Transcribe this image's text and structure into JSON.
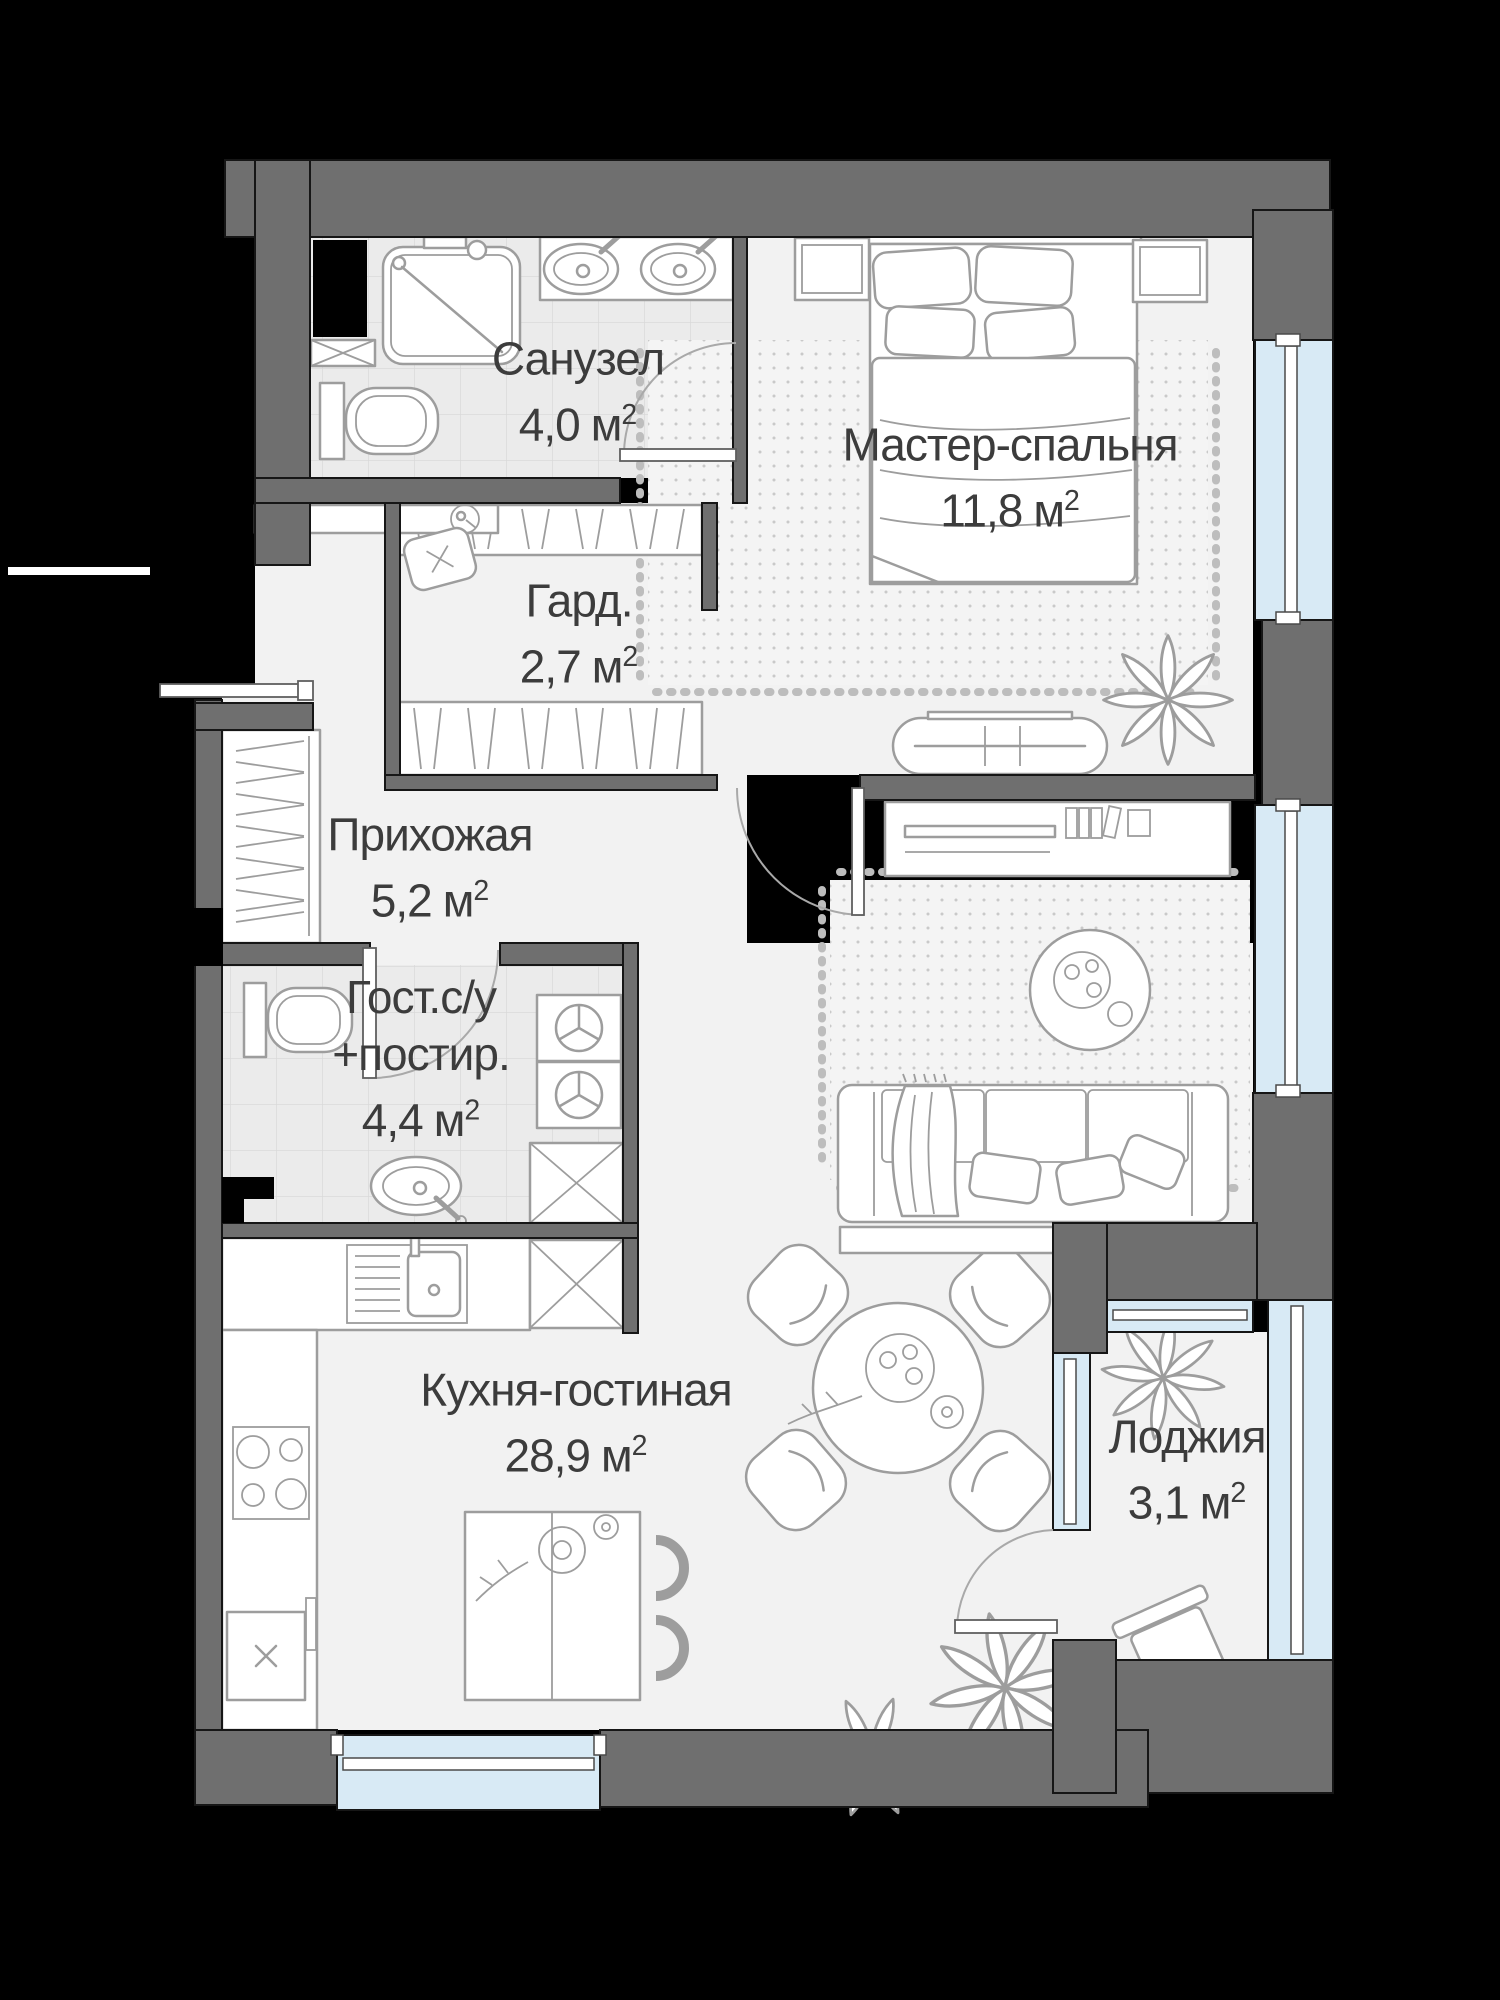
{
  "colors": {
    "background": "#000000",
    "wall": "#6f6f6f",
    "floor": "#f2f2f2",
    "tile": "#ebebeb",
    "tile_line": "#d9d9d9",
    "glass": "#d8eaf5",
    "line": "#9d9d9d",
    "text": "#3c3c3c",
    "rug_dot": "#c9c9c9",
    "fringe": "#bdbdbd",
    "door": "#a9a9a9"
  },
  "rooms": [
    {
      "id": "bathroom",
      "name": "Санузел",
      "area_value": "4,0",
      "area_unit": "м",
      "area_sup": "2"
    },
    {
      "id": "master-bedroom",
      "name": "Мастер-спальня",
      "area_value": "11,8",
      "area_unit": "м",
      "area_sup": "2"
    },
    {
      "id": "wardrobe",
      "name": "Гард.",
      "area_value": "2,7",
      "area_unit": "м",
      "area_sup": "2"
    },
    {
      "id": "hallway",
      "name": "Прихожая",
      "area_value": "5,2",
      "area_unit": "м",
      "area_sup": "2"
    },
    {
      "id": "guest-bathroom",
      "name": "Гост.с/у",
      "name_line2": "+постир.",
      "area_value": "4,4",
      "area_unit": "м",
      "area_sup": "2"
    },
    {
      "id": "kitchen-living",
      "name": "Кухня-гостиная",
      "area_value": "28,9",
      "area_unit": "м",
      "area_sup": "2"
    },
    {
      "id": "loggia",
      "name": "Лоджия",
      "area_value": "3,1",
      "area_unit": "м",
      "area_sup": "2"
    }
  ]
}
